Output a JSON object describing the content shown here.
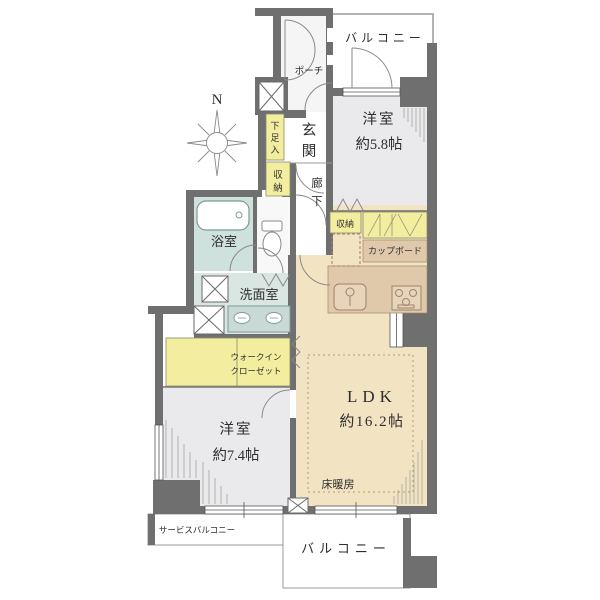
{
  "floorplan": {
    "compass": {
      "north": "N"
    },
    "colors": {
      "wall": "#6f6f6f",
      "ldk_floor": "#f2e3c3",
      "room_floor": "#eaeaec",
      "bath_floor": "#cfe1dd",
      "washroom_floor": "#d9e6e2",
      "storage_yellow": "#f2ed9f",
      "counter_tan": "#e0c9ab"
    },
    "rooms": {
      "balcony_top": {
        "label": "バルコニー"
      },
      "porch": {
        "label": "ポーチ"
      },
      "bedroom1": {
        "name": "洋室",
        "size": "約5.8帖"
      },
      "shoe_cabinet": {
        "chars": [
          "下",
          "足",
          "入"
        ]
      },
      "entrance": {
        "chars": [
          "玄",
          "関"
        ]
      },
      "entrance_storage": {
        "chars": [
          "収",
          "納"
        ]
      },
      "hallway": {
        "chars": [
          "廊",
          "下"
        ]
      },
      "bathroom": {
        "label": "浴室"
      },
      "washroom": {
        "label": "洗面室"
      },
      "bedroom1_storage": {
        "label": "収納"
      },
      "cupboard": {
        "label": "カップボード"
      },
      "ldk": {
        "name": "LDK",
        "size": "約16.2帖",
        "floor_heating": "床暖房"
      },
      "wic": {
        "line1": "ウォークイン",
        "line2": "クローゼット"
      },
      "bedroom2": {
        "name": "洋室",
        "size": "約7.4帖"
      },
      "service_balcony": {
        "label": "サービスバルコニー"
      },
      "balcony_bottom": {
        "label": "バルコニー"
      }
    }
  }
}
